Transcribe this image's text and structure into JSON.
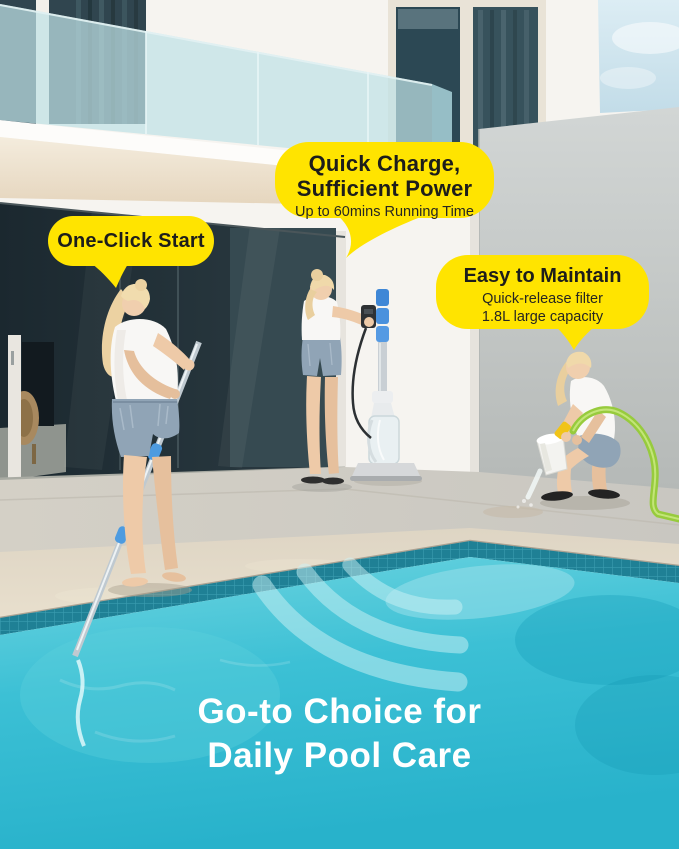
{
  "callouts": {
    "quick_charge": {
      "title": "Quick Charge,\nSufficient Power",
      "subtitle": "Up to 60mins Running Time"
    },
    "one_click": {
      "title": "One-Click Start"
    },
    "easy_maintain": {
      "title": "Easy to Maintain",
      "subtitle": "Quick-release filter\n1.8L large capacity"
    }
  },
  "caption": {
    "title": "Go-to Choice for\nDaily Pool Care"
  },
  "colors": {
    "callout_bg": "#FFE400",
    "callout_text": "#1D1D1B",
    "caption_text": "#FFFFFF",
    "pool_water_light": "#6FD5E0",
    "pool_water_deep": "#2DB4CD",
    "pool_tile": "#1F8095",
    "deck_beige": "#E3DAC8",
    "wall_gray": "#C7CBC9",
    "hose_green": "#97CB3D",
    "pole_joint_blue": "#4D9BE0",
    "balcony_glass": "#BFE2E6"
  }
}
